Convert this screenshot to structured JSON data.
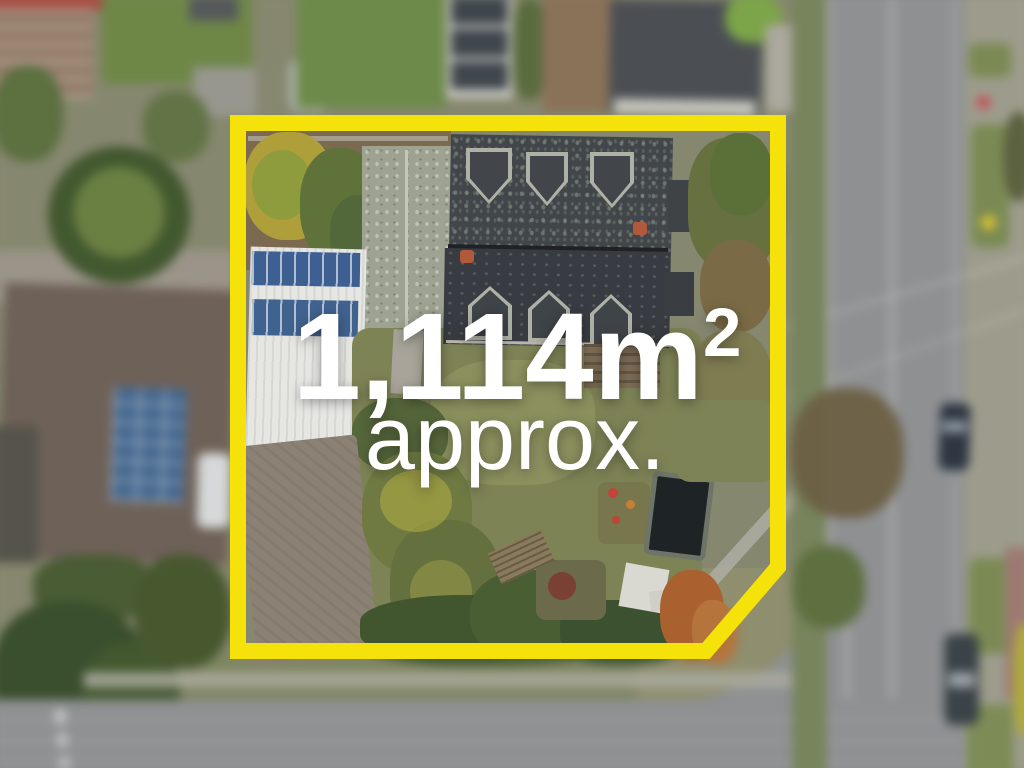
{
  "overlay": {
    "area_value": "1,114m",
    "area_superscript": "2",
    "approx_label": "approx."
  },
  "boundary": {
    "color": "#F6E20B",
    "shape": "rectangle-with-chamfered-bottom-right-corner"
  },
  "text_color": "#FFFFFF",
  "photo": {
    "description": "aerial-drone-view-of-residential-property",
    "focus": "property-inside-boundary-sharp-surroundings-blurred"
  }
}
